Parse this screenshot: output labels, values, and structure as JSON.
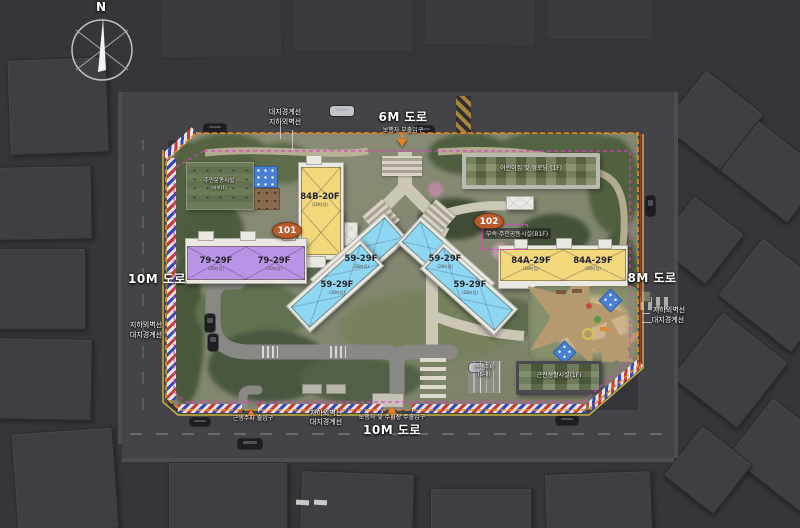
{
  "page": {
    "type": "apartment-complex-site-plan"
  },
  "compass": {
    "north_label": "N"
  },
  "roads": {
    "top": {
      "name": "6M 도로",
      "entrance_label": "보행자 부출입구"
    },
    "left": {
      "name": "10M 도로"
    },
    "right": {
      "name": "8M 도로"
    },
    "bottom": {
      "name": "10M 도로",
      "entrance_label": "보행자 및 주차장 주출입구"
    },
    "service_entrance_label": "근생주차 출입구"
  },
  "boundary_labels": {
    "site": "대지경계선",
    "basement_wall": "지하외벽선"
  },
  "block_badges": {
    "b101": "101",
    "b102": "102"
  },
  "buildings": {
    "b84b": {
      "label": "84B-20F",
      "sub": "(1B타입)"
    },
    "b79_1": {
      "label": "79-29F",
      "sub": "(2B타입)"
    },
    "b79_2": {
      "label": "79-29F",
      "sub": "(2B타입)"
    },
    "b59_1": {
      "label": "59-29F",
      "sub": "(2B타입)"
    },
    "b59_2": {
      "label": "59-29F",
      "sub": "(2B타입)"
    },
    "b59_3": {
      "label": "59-29F",
      "sub": "(2B타입)"
    },
    "b59_4": {
      "label": "59-29F",
      "sub": "(2B타입)"
    },
    "b84a_1": {
      "label": "84A-29F",
      "sub": "(2B타입)"
    },
    "b84a_2": {
      "label": "84A-29F",
      "sub": "(2B타입)"
    }
  },
  "facilities": {
    "sports_deck": {
      "label": "주민운동시설",
      "sub": "(지하1F)"
    },
    "daycare_senior": {
      "label": "어린이집 및 경로당 (1F)"
    },
    "community_annex": {
      "label": "부속 주민공동시설(B1F)"
    },
    "retail": {
      "label": "근린생활시설(1F)"
    },
    "retail_parking": {
      "label": "근생주차",
      "sub": "(5대)"
    }
  },
  "colors": {
    "type_59": "#8ed7f2",
    "type_79": "#ba93e6",
    "type_84": "#f3d77b",
    "site_boundary_line": "#ef8820",
    "basement_wall_line": "#e23cc8",
    "entrance_arrow": "#ea7f24",
    "block_badge": "#b85c2e"
  }
}
